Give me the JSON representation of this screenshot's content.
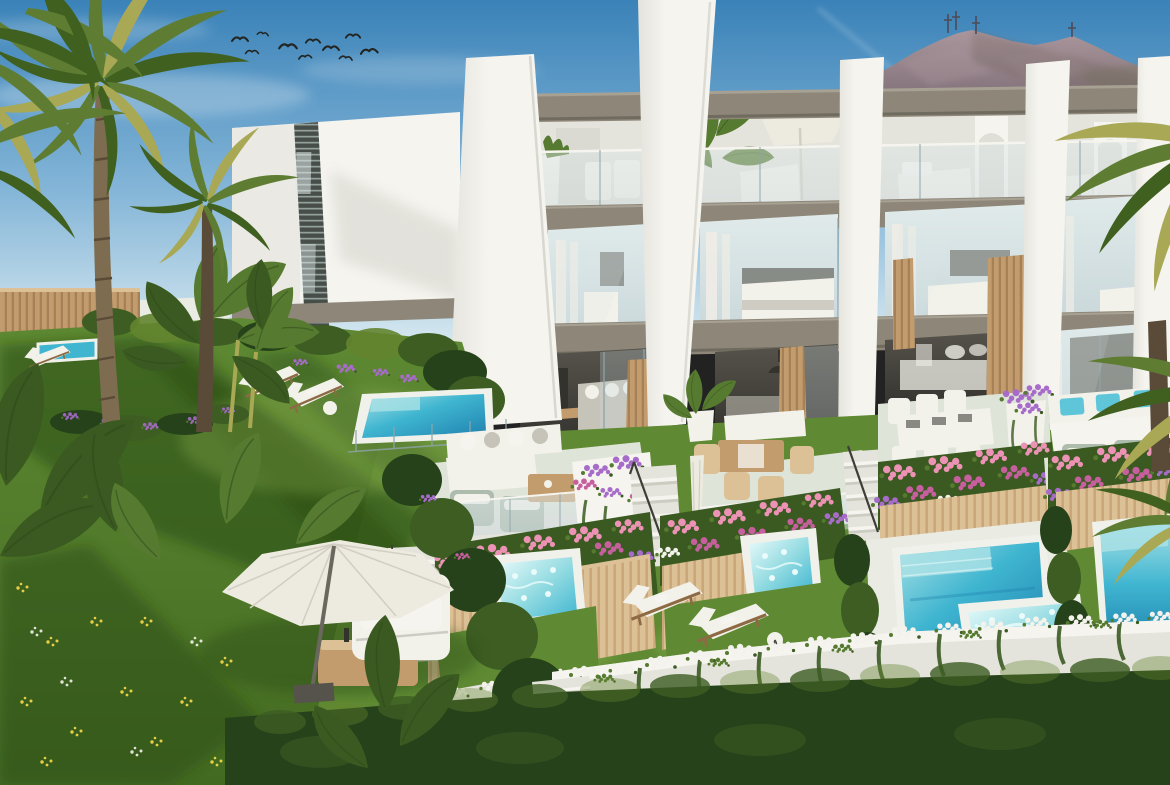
{
  "scene": {
    "type": "photorealistic architectural rendering",
    "view": "aerial three-quarter view, sunny day",
    "subject": "modern white three-storey terraced townhouses with covered rooftop terraces, glass balustrades, wood-slat accents, private gardens with plunge pools and jacuzzis",
    "background": [
      "clear blue sky",
      "flock of birds",
      "mountain ridge with antenna masts",
      "neighbouring white building with louvred window strip"
    ],
    "foreground": [
      "palm trees",
      "banana plants",
      "lawns with wildflowers",
      "bougainvillea planters",
      "garden parasol with lounge chair",
      "sun loungers",
      "white stair flights",
      "dark shrub hedge"
    ]
  },
  "counts": {
    "birds": 10,
    "visible_townhouse_units": 4,
    "white_facade_fins": 5,
    "swimming_pools": 3,
    "jacuzzis": 3,
    "left_garden_loungers": 2,
    "lawn_loungers": 2,
    "garden_parasols": 1,
    "antenna_masts": 4
  },
  "palette": {
    "sky_top": "#3a82b8",
    "sky_mid": "#85b6d8",
    "sky_low": "#d9eaf1",
    "cloud": "#edf4f7",
    "mtn": "#8a7880",
    "mtn_dk": "#6e6158",
    "mtn_lt": "#aa979d",
    "mtn_gr": "#75785a",
    "antenna": "#4f4a55",
    "bird": "#23231f",
    "wall": "#f5f4ef",
    "wall_sh": "#e4e3dc",
    "wall_dk": "#ccccc3",
    "slab": "#8e8779",
    "slab_dk": "#6f6b5f",
    "slab_lt": "#a7a193",
    "louver": "#474e49",
    "louver_lt": "#a6b4b0",
    "glass": "#c9d7da",
    "glass_hi": "#e0eaea",
    "glass_dk": "#8ea4a8",
    "curtain": "#eeece6",
    "interior": "#55534b",
    "interior_dk": "#34322d",
    "wood": "#c39c6d",
    "wood_dk": "#8e6a44",
    "wood_lt": "#dcc096",
    "tfloor": "#dfe4d8",
    "deck": "#eaece3",
    "furn": "#f2f1ea",
    "cushion": "#c6c4b9",
    "cushion_blue": "#5fc6da",
    "sage": "#aebcae",
    "umb": "#edebe0",
    "umb_dk": "#d2cfc2",
    "grass_hi": "#90b252",
    "grass": "#5f8a33",
    "grass_dk": "#436a21",
    "grass_sh": "#2a4a16",
    "hedge": "#3d5d23",
    "hedge_dk": "#26421a",
    "hedge_hi": "#63842f",
    "fl_pink": "#ec93b5",
    "fl_mag": "#c75f9f",
    "fl_pur": "#a76cc9",
    "fl_wht": "#f4f2ec",
    "fl_yel": "#e7cf45",
    "leaf": "#567a30",
    "leaf_dk": "#3a5a21",
    "pool_rim": "#f0f1ea",
    "pool_hi": "#a9e1e5",
    "pool_mid": "#3fb5d0",
    "pool_deep": "#1f80ae",
    "jac": "#95dce2",
    "foam": "#ebfbfb",
    "palm": "#5e7d33",
    "palm_dk": "#40601f",
    "palm_yl": "#a9a855",
    "trunk": "#7d6c4f",
    "trunk_dk": "#594b37",
    "shade": "#16240d"
  }
}
